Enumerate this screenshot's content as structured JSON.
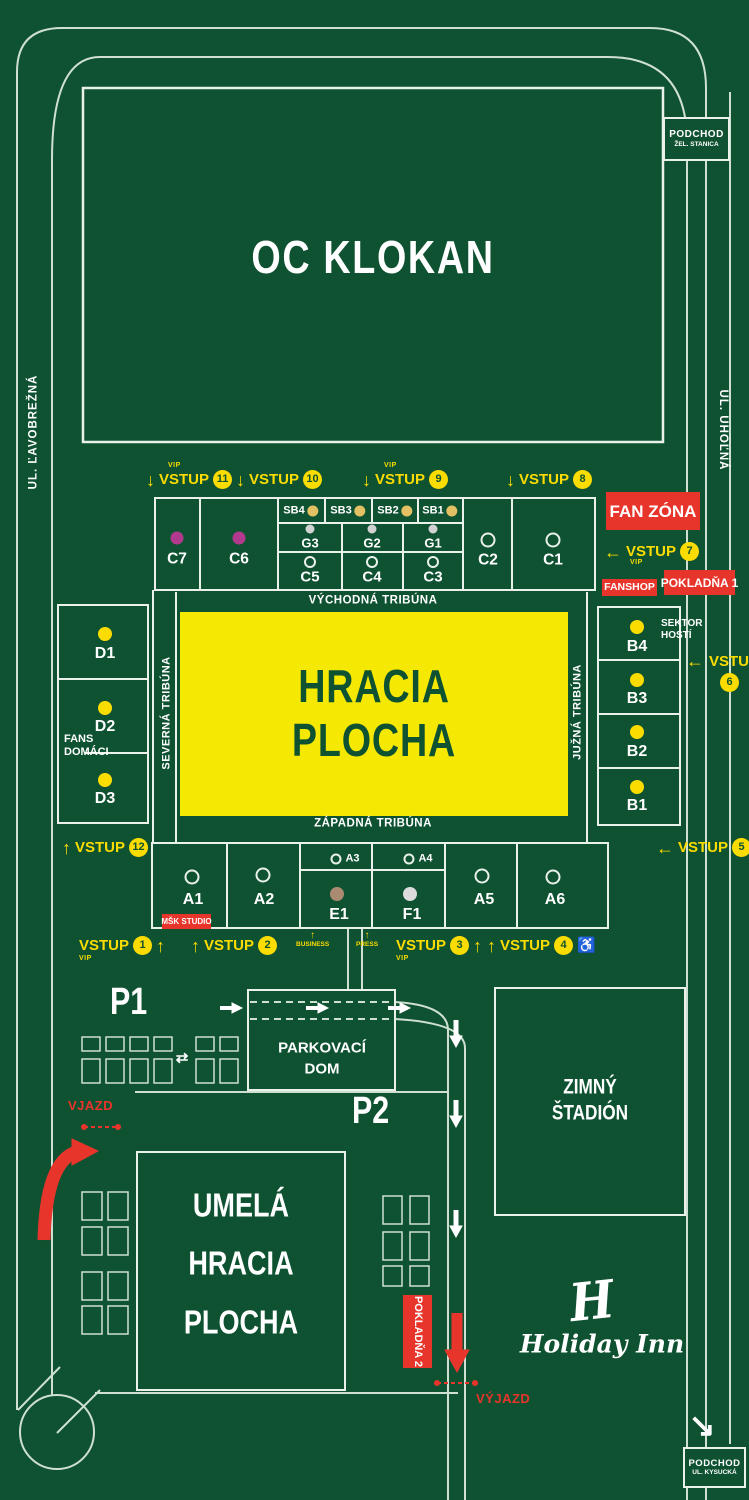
{
  "colors": {
    "background": "#0e5231",
    "road_line": "#cfe0d2",
    "accent_yellow": "#fbdc00",
    "accent_red": "#e8352b",
    "field_yellow": "#f5e903",
    "dot_magenta": "#b13a8e",
    "dot_gold": "#e2c063",
    "dot_gray": "#d2d2d2",
    "dot_tan": "#ab8a72",
    "dot_white": "#dcdcdc"
  },
  "streets": {
    "left": "UL. ĽAVOBREŽNÁ",
    "right": "UL. UHOĽNÁ"
  },
  "landmarks": {
    "oc_klokan": "OC KLOKAN",
    "podchod_top": {
      "line1": "PODCHOD",
      "line2": "ŽEL. STANICA"
    },
    "podchod_bottom": {
      "line1": "PODCHOD",
      "line2": "UL. KYSUCKÁ"
    },
    "zimny": {
      "line1": "ZIMNÝ",
      "line2": "ŠTADIÓN"
    },
    "umela": {
      "line1": "UMELÁ",
      "line2": "HRACIA",
      "line3": "PLOCHA"
    },
    "holiday_inn": {
      "initial": "H",
      "name": "Holiday Inn"
    }
  },
  "field": {
    "line1": "HRACIA",
    "line2": "PLOCHA"
  },
  "tribunes": {
    "east": "VÝCHODNÁ TRIBÚNA",
    "west": "ZÁPADNÁ TRIBÚNA",
    "north": "SEVERNÁ TRIBÚNA",
    "south": "JUŽNÁ TRIBÚNA"
  },
  "zones": {
    "fan_zona": "FAN ZÓNA",
    "fanshop": "FANSHOP",
    "pokladna1": "POKLADŇA 1",
    "pokladna2": "POKLADŇA 2",
    "msk_studio": "MŠK STUDIO",
    "fans_domaci": {
      "line1": "FANS",
      "line2": "DOMÁCI"
    },
    "sektor_hosti": {
      "line1": "SEKTOR",
      "line2": "HOSTÍ"
    },
    "vjazd": "VJAZD",
    "vyjazd": "VÝJAZD"
  },
  "parking": {
    "p1": "P1",
    "p2": "P2",
    "dom": {
      "line1": "PARKOVACÍ",
      "line2": "DOM"
    }
  },
  "icons": {
    "arrow_up": "↑",
    "arrow_down": "↓",
    "arrow_left": "←",
    "two_way": "⇄",
    "down_right": "↘",
    "wheelchair": "♿"
  },
  "stands": {
    "east": {
      "c7": "C7",
      "c6": "C6",
      "sb4": "SB4",
      "sb3": "SB3",
      "sb2": "SB2",
      "sb1": "SB1",
      "g3": "G3",
      "g2": "G2",
      "g1": "G1",
      "c5": "C5",
      "c4": "C4",
      "c3": "C3",
      "c2": "C2",
      "c1": "C1"
    },
    "north": {
      "d1": "D1",
      "d2": "D2",
      "d3": "D3"
    },
    "south": {
      "b4": "B4",
      "b3": "B3",
      "b2": "B2",
      "b1": "B1"
    },
    "west": {
      "a1": "A1",
      "a2": "A2",
      "a3": "A3",
      "a4": "A4",
      "e1": "E1",
      "f1": "F1",
      "a5": "A5",
      "a6": "A6"
    }
  },
  "entrances": {
    "e1": {
      "label": "VSTUP",
      "number": "1",
      "vip": "VIP",
      "arrow": "↑"
    },
    "e2": {
      "label": "VSTUP",
      "number": "2",
      "arrow": "↑"
    },
    "e3": {
      "label": "VSTUP",
      "number": "3",
      "vip": "VIP",
      "arrow": "↑"
    },
    "e4": {
      "label": "VSTUP",
      "number": "4",
      "arrow": "↑",
      "wheelchair": "♿"
    },
    "e5": {
      "label": "VSTUP",
      "number": "5",
      "arrow": "←"
    },
    "e6": {
      "label": "VSTUP",
      "number": "6",
      "arrow": "←"
    },
    "e7": {
      "label": "VSTUP",
      "number": "7",
      "vip": "VIP",
      "arrow": "←"
    },
    "e8": {
      "label": "VSTUP",
      "number": "8",
      "arrow": "↓"
    },
    "e9": {
      "label": "VSTUP",
      "number": "9",
      "vip": "VIP",
      "arrow": "↓"
    },
    "e10": {
      "label": "VSTUP",
      "number": "10",
      "arrow": "↓"
    },
    "e11": {
      "label": "VSTUP",
      "number": "11",
      "vip": "VIP",
      "arrow": "↓"
    },
    "e12": {
      "label": "VSTUP",
      "number": "12",
      "arrow": "↑"
    },
    "business": "BUSINESS",
    "press": "PRESS"
  }
}
